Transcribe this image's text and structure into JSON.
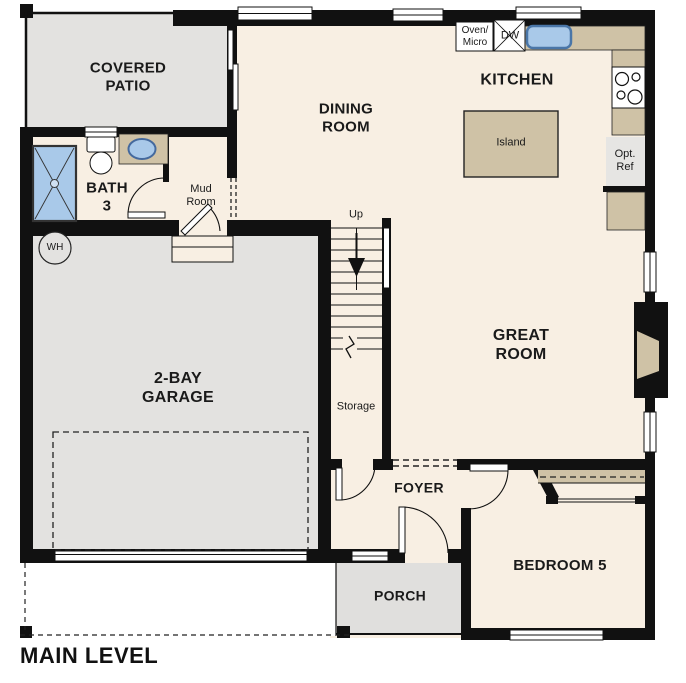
{
  "title": "MAIN LEVEL",
  "rooms": {
    "covered_patio": "COVERED\nPATIO",
    "dining_room": "DINING\nROOM",
    "kitchen": "KITCHEN",
    "great_room": "GREAT\nROOM",
    "bath_3": "BATH\n3",
    "mud_room": "Mud\nRoom",
    "garage": "2-BAY\nGARAGE",
    "foyer": "FOYER",
    "porch": "PORCH",
    "bedroom_5": "BEDROOM 5",
    "storage": "Storage"
  },
  "fixtures": {
    "island": "Island",
    "oven_micro": "Oven/\nMicro",
    "dishwasher": "DW",
    "optional_refrigerator": "Opt.\nRef",
    "water_heater": "WH",
    "stairs_direction": "Up"
  },
  "colors": {
    "wall": "#111111",
    "floor": "#f8efe3",
    "concrete_gray": "#e3e2e0",
    "counter_tan": "#cfc2a6",
    "plumbing_blue": "#a9c9e9"
  }
}
